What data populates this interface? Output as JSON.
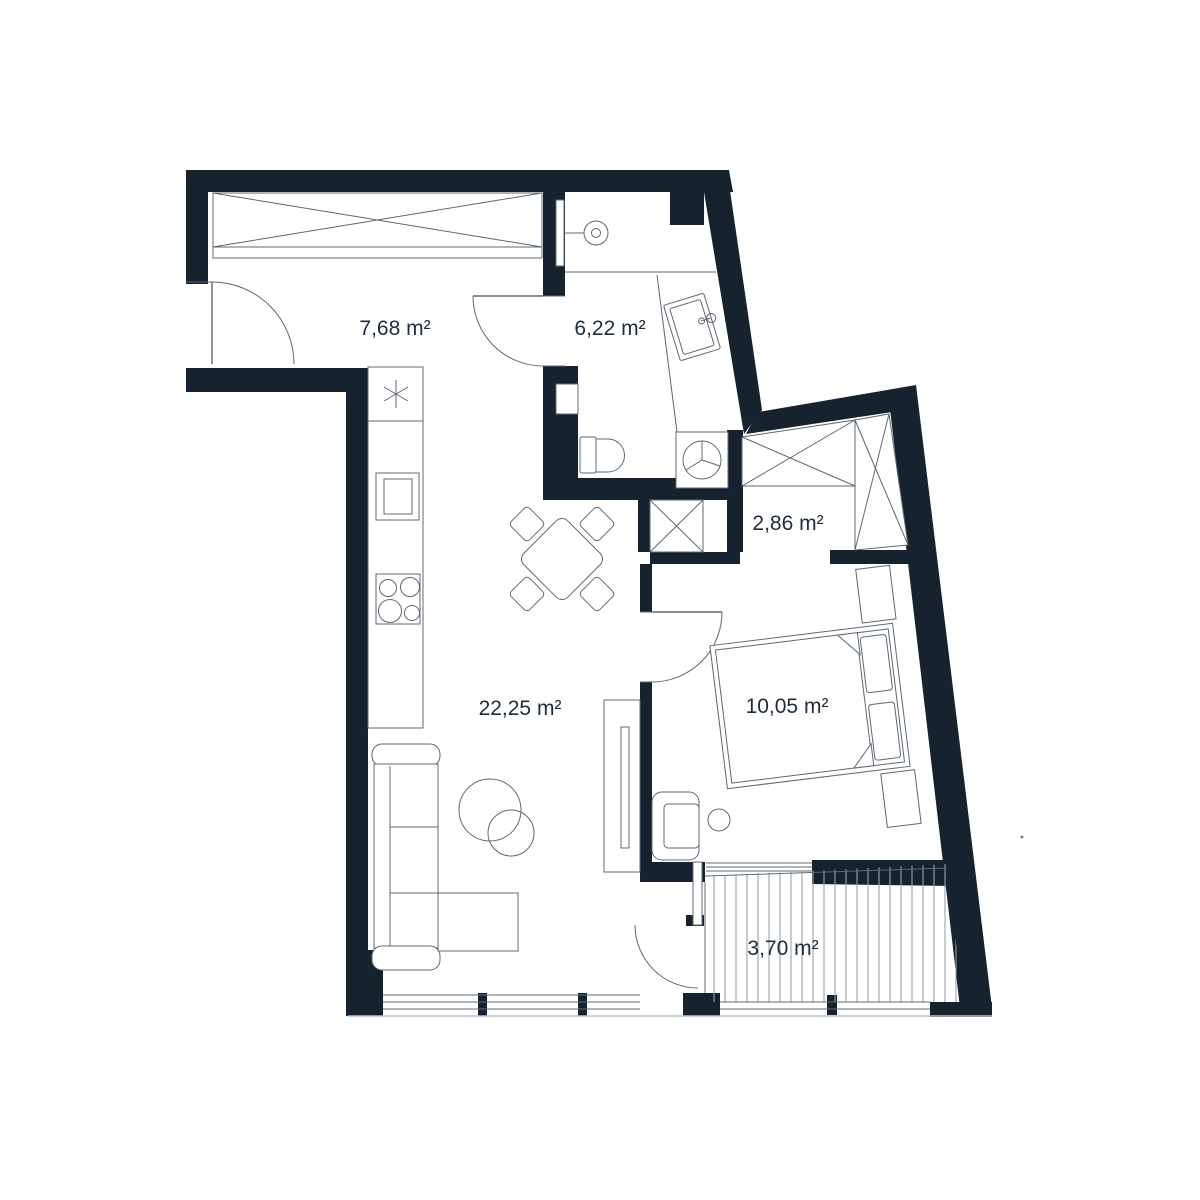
{
  "plan": {
    "type": "apartment-floor-plan",
    "colors": {
      "wall": "#16232f",
      "line": "#5c6873",
      "line_light": "#b9c0c6",
      "deck_stripe": "#9aa2ab",
      "text": "#1e2d3b",
      "background": "#ffffff"
    },
    "rooms": [
      {
        "name": "hallway",
        "area_label": "7,68 m²"
      },
      {
        "name": "bathroom",
        "area_label": "6,22 m²"
      },
      {
        "name": "wardrobe-room",
        "area_label": "2,86 m²"
      },
      {
        "name": "living-kitchen",
        "area_label": "22,25 m²"
      },
      {
        "name": "bedroom",
        "area_label": "10,05 m²"
      },
      {
        "name": "balcony",
        "area_label": "3,70 m²"
      }
    ]
  }
}
